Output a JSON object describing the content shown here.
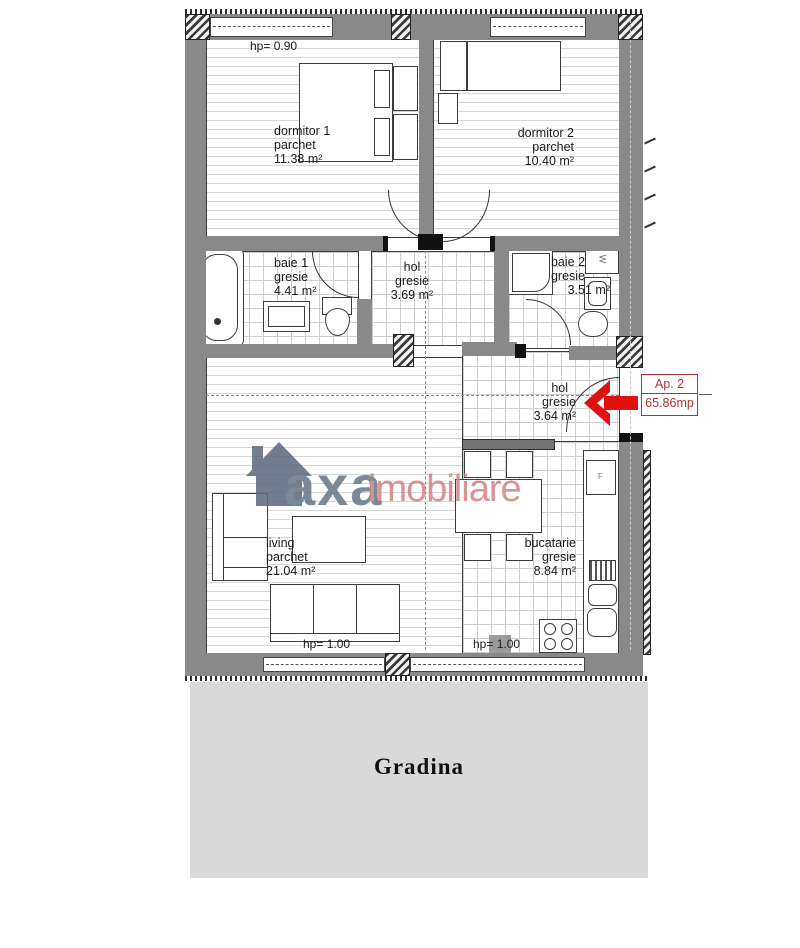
{
  "title": "Apartment floor plan Ap. 2",
  "rooms": [
    {
      "name": "dormitor 1",
      "floor": "parchet",
      "area": "11.38 m²"
    },
    {
      "name": "dormitor 2",
      "floor": "parchet",
      "area": "10.40 m²"
    },
    {
      "name": "baie 1",
      "floor": "gresie",
      "area": "4.41 m²"
    },
    {
      "name": "hol",
      "floor": "gresie",
      "area": "3.69 m²"
    },
    {
      "name": "baie 2",
      "floor": "gresie",
      "area": "3.51 m²"
    },
    {
      "name": "hol",
      "floor": "gresie",
      "area": "3.64 m²"
    },
    {
      "name": "living",
      "floor": "parchet",
      "area": "21.04 m²"
    },
    {
      "name": "bucatarie",
      "floor": "gresie",
      "area": "8.84 m²"
    }
  ],
  "annotations": {
    "parapet_top": "hp= 0.90",
    "parapet_living": "hp= 1.00",
    "parapet_kitchen": "hp= 1.00"
  },
  "apartment_tag": {
    "name": "Ap. 2",
    "area": "65.86mp"
  },
  "garden": {
    "label": "Gradina"
  },
  "watermark": {
    "brand": "axa",
    "suffix": "imobiliare"
  },
  "appliances": {
    "fridge": "F",
    "washer": "W"
  },
  "colors": {
    "arrow_red": "#e01111",
    "tag_red": "#b03434",
    "wall_gray": "#898989",
    "garden_gray": "#d9d9d9",
    "brand_gray": "#6b7989",
    "brand_red": "#d68585"
  }
}
